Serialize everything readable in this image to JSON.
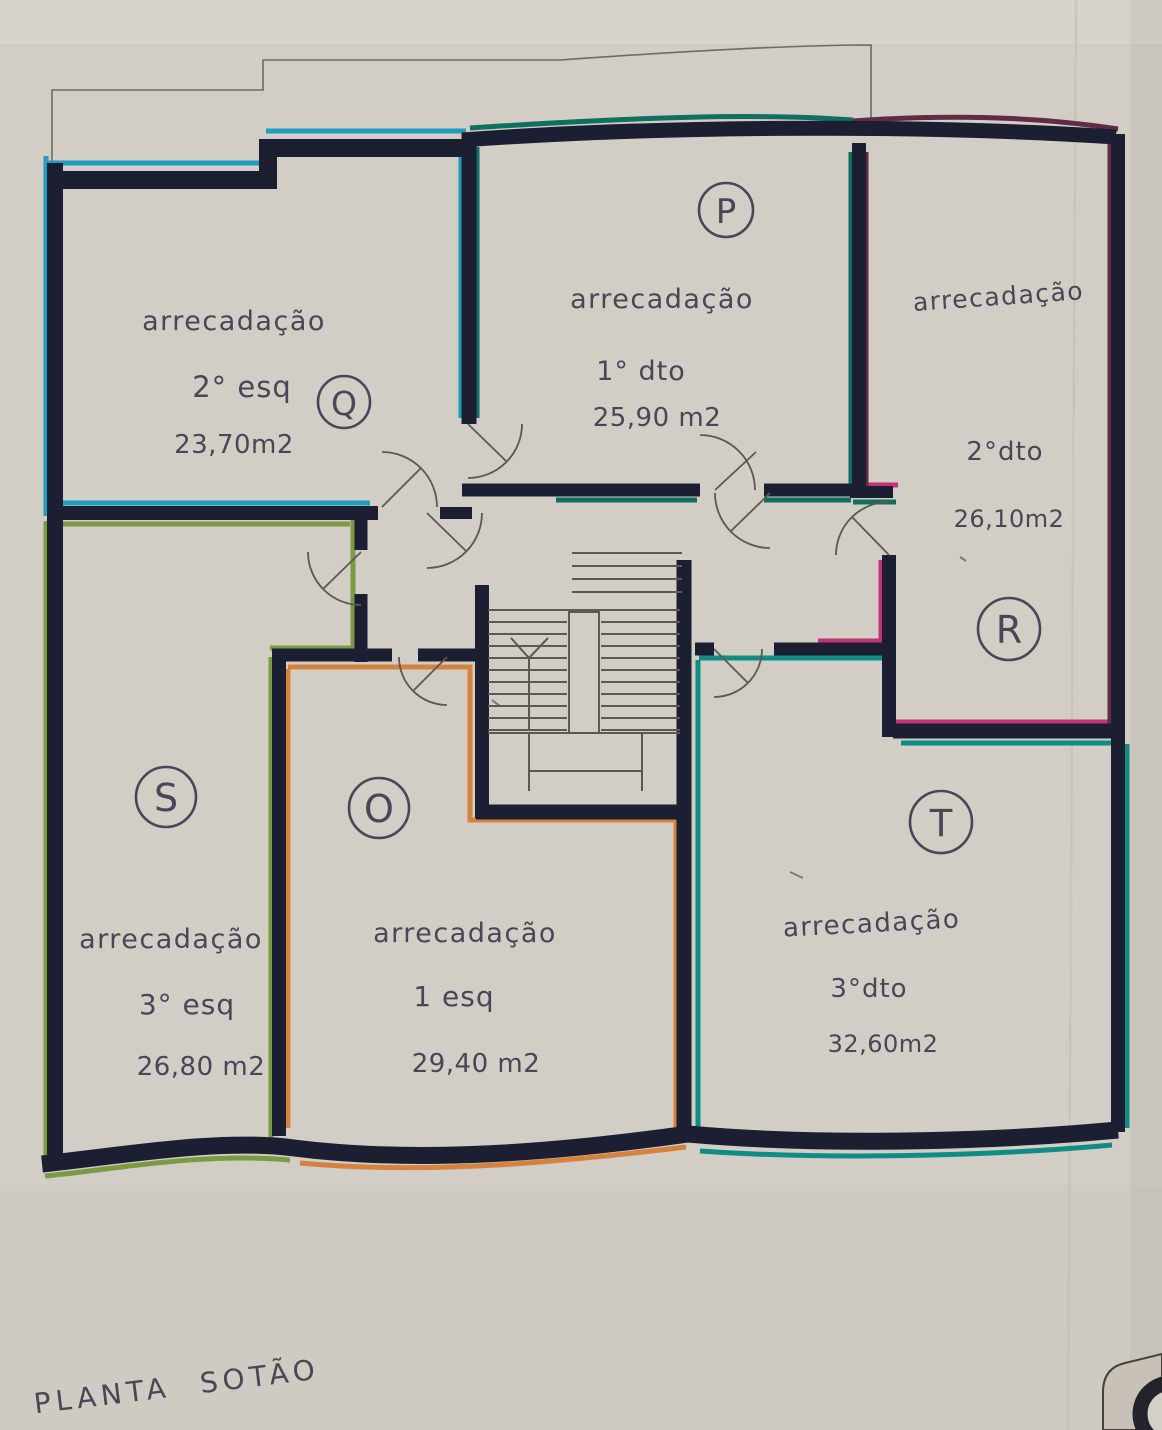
{
  "plan": {
    "footer_label": "PLANTA  SOTÃO",
    "rooms": [
      {
        "letter": "Q",
        "name": "arrecadação",
        "unit": "2° esq",
        "area": "23,70m2",
        "accent": "#1f9dbf"
      },
      {
        "letter": "P",
        "name": "arrecadação",
        "unit": "1° dto",
        "area": "25,90 m2",
        "accent": "#0f7060"
      },
      {
        "letter": "R",
        "name": "arrecadação",
        "unit": "2°dto",
        "area": "26,10m2",
        "accent": "#c23375"
      },
      {
        "letter": "S",
        "name": "arrecadação",
        "unit": "3° esq",
        "area": "26,80 m2",
        "accent": "#7a9b42"
      },
      {
        "letter": "O",
        "name": "arrecadação",
        "unit": "1 esq",
        "area": "29,40 m2",
        "accent": "#d5823e"
      },
      {
        "letter": "T",
        "name": "arrecadação",
        "unit": "3°dto",
        "area": "32,60m2",
        "accent": "#0f8d85"
      }
    ],
    "colors": {
      "wall": "#1c1f31",
      "paper": "#d2cdc5",
      "thin_line": "#5d5852",
      "roof_outline": "#6f6a63",
      "text": "#474757",
      "maroon": "#5f2b45"
    }
  }
}
